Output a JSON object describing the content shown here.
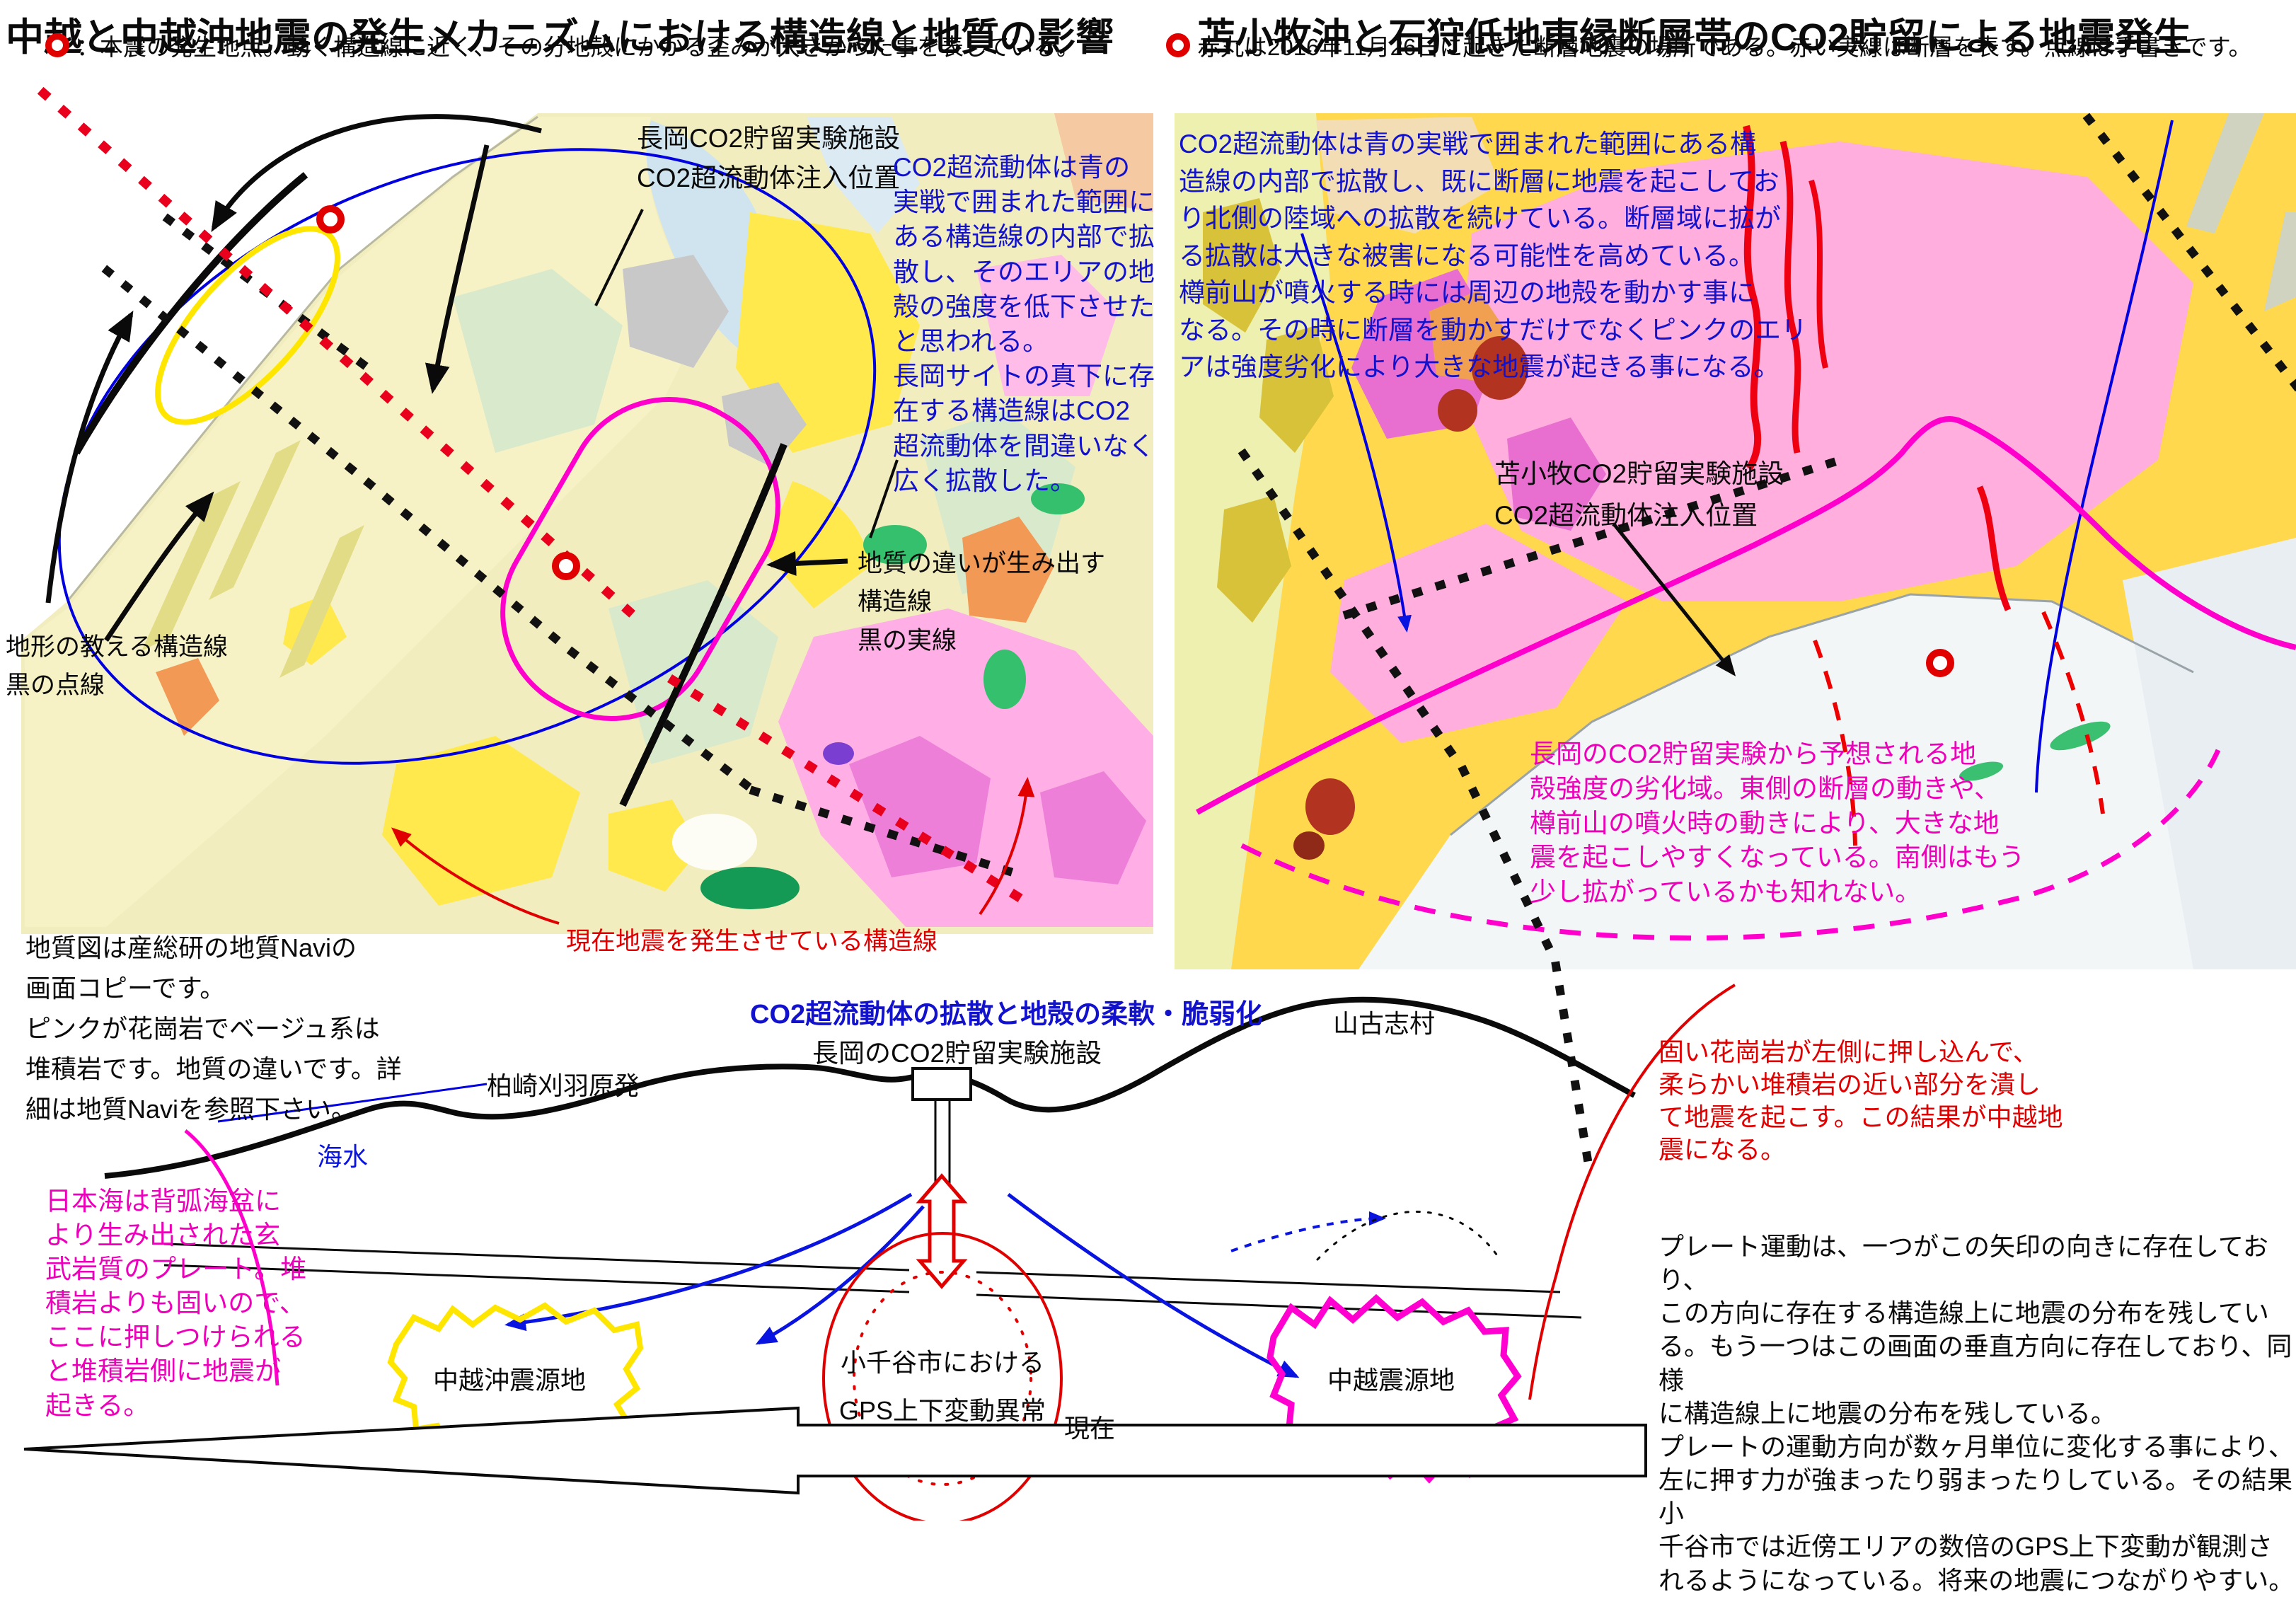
{
  "left_panel": {
    "title": "中越と中越沖地震の発生メカニズムにおける構造線と地質の影響",
    "legend": "：本震の発生地点。動く構造線に近く、その分地殻にかかる歪みが大きかった事を表している。",
    "facility_label": "長岡CO2貯留実験施設\nCO2超流動体注入位置",
    "co2_note": "CO2超流動体は青の\n実戦で囲まれた範囲に\nある構造線の内部で拡\n散し、そのエリアの地\n殻の強度を低下させた\nと思われる。\n長岡サイトの真下に存\n在する構造線はCO2\n超流動体を間違いなく\n広く拡散した。",
    "geology_line_label": "地質の違いが生み出す\n構造線\n黒の実線",
    "terrain_line_label": "地形の教える構造線\n黒の点線",
    "active_fault_label": "現在地震を発生させている構造線",
    "source_note": "地質図は産総研の地質Naviの\n画面コピーです。\nピンクが花崗岩でベージュ系は\n堆積岩です。地質の違いです。詳\n細は地質Naviを参照下さい。"
  },
  "right_panel": {
    "title": "苫小牧沖と石狩低地東縁断層帯のCO2貯留による地震発生",
    "legend": "赤丸は2016年11月26日に起きた断層地震の場所である。赤い実線は断層を表す。点線は手書きです。",
    "co2_note": "CO2超流動体は青の実戦で囲まれた範囲にある構\n造線の内部で拡散し、既に断層に地震を起こしてお\nり北側の陸域への拡散を続けている。断層域に拡が\nる拡散は大きな被害になる可能性を高めている。\n樽前山が噴火する時には周辺の地殻を動かす事に\nなる。その時に断層を動かすだけでなくピンクのエリ\nアは強度劣化により大きな地震が起きる事になる。",
    "facility_label": "苫小牧CO2貯留実験施設\nCO2超流動体注入位置",
    "weakened_zone_note": "長岡のCO2貯留実験から予想される地\n殻強度の劣化域。東側の断層の動きや、\n樽前山の噴火時の動きにより、大きな地\n震を起こしやすくなっている。南側はもう\n少し拡がっているかも知れない。"
  },
  "cross_section": {
    "heading_blue": "CO2超流動体の拡散と地殻の柔軟・脆弱化",
    "heading_black": "長岡のCO2貯留実験施設",
    "yamakoshi_label": "山古志村",
    "kashiwazaki_label": "柏崎刈羽原発",
    "seawater_label": "海水",
    "chuetsu_oki_label": "中越沖震源地",
    "ojiya_label": "小千谷市における\nGPS上下変動異常",
    "present_label": "現在",
    "chuetsu_label": "中越震源地",
    "basalt_note": "日本海は背弧海盆に\nより生み出された玄\n武岩質のプレート。堆\n積岩よりも固いので、\nここに押しつけられる\nと堆積岩側に地震が\n起きる。",
    "granite_note": "固い花崗岩が左側に押し込んで、\n柔らかい堆積岩の近い部分を潰し\nて地震を起こす。この結果が中越地\n震になる。",
    "plate_note": "プレート運動は、一つがこの矢印の向きに存在しており、\nこの方向に存在する構造線上に地震の分布を残してい\nる。もう一つはこの画面の垂直方向に存在しており、同様\nに構造線上に地震の分布を残している。\nプレートの運動方向が数ヶ月単位に変化する事により、\n左に押す力が強まったり弱まったりしている。その結果小\n千谷市では近傍エリアの数倍のGPS上下変動が観測さ\nれるようになっている。将来の地震につながりやすい。"
  },
  "colors": {
    "annotation_blue": "#1212cc",
    "annotation_magenta": "#ee00bb",
    "annotation_red": "#e00000",
    "blob_yellow": "#ffe600",
    "blob_magenta": "#ff00cc"
  }
}
